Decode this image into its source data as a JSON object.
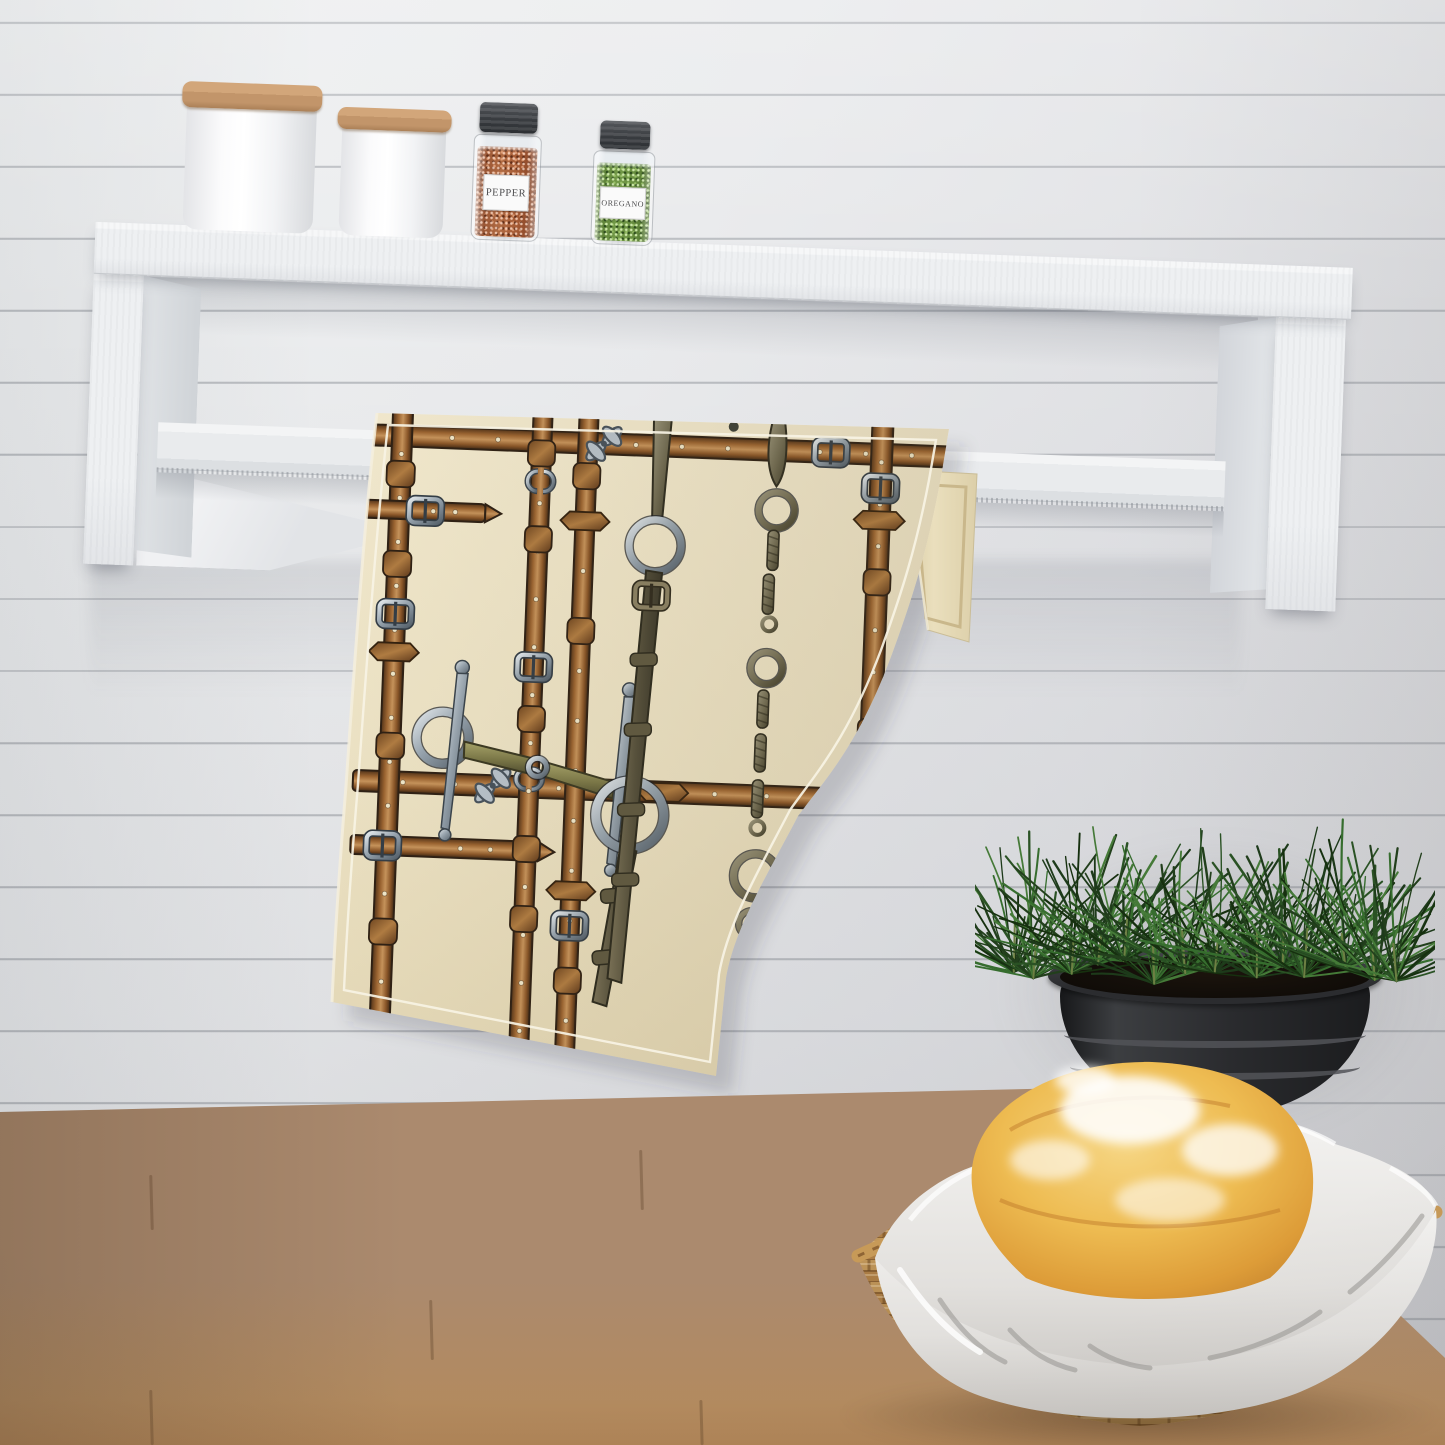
{
  "scene": {
    "description": "Kitchen tea-towel product mockup: patterned towel hanging from a white wall shelf with towel bar, spice jars above, potted herb and bread basket on a wood counter",
    "wall": {
      "style": "white shiplap planks",
      "base_color": "#e8e9eb",
      "groove_color": "#c7cacd"
    },
    "shelf": {
      "material": "whitewashed wood",
      "color": "#eef0f2"
    },
    "counter": {
      "material": "wood butcher block",
      "back_color": "#b29780",
      "front_color": "#c2914f"
    }
  },
  "shelf_items": {
    "canister_large": {
      "body_color": "#fbfbfc",
      "lid_color": "#c2956a"
    },
    "canister_small": {
      "body_color": "#f7f8f9",
      "lid_color": "#c2956a"
    },
    "spice_jars": [
      {
        "label": "PEPPER",
        "contents_color": "#a55a34",
        "cap_color": "#393c40"
      },
      {
        "label": "OREGANO",
        "contents_color": "#688e3f",
        "cap_color": "#393c40"
      }
    ]
  },
  "towel": {
    "base_color": "#ece3c6",
    "back_fold_color": "#e7dcba",
    "pattern_theme": "equestrian: leather bridle straps, silver buckles, snaffle bit, chain rings",
    "leather_color": "#9a6330",
    "metal_color": "#98a5b0",
    "bit_mouthpiece_color": "#7b7848",
    "stitch_color": "#f7f3e4"
  },
  "decor": {
    "plant": {
      "type": "needle-leaf herb",
      "foliage_color": "#2a5224",
      "pot_color": "#2a2b2e"
    },
    "bread": {
      "crust_color": "#e7a83c",
      "flour_color": "#ffffff"
    },
    "basket": {
      "weave_color": "#c59a5c",
      "liner_color": "#efeeec"
    }
  }
}
